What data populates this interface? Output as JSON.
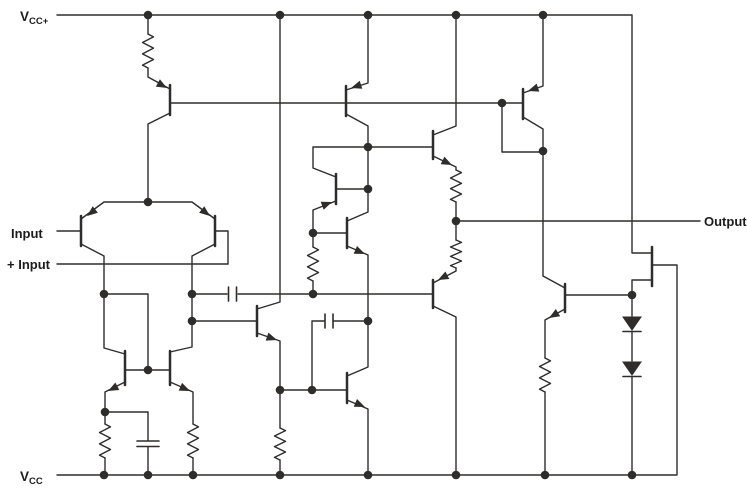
{
  "figure": {
    "width": 747,
    "height": 497,
    "background": "#ffffff",
    "line_color": "#2e2d2c",
    "label_color": "#1c1c1c"
  },
  "labels": [
    {
      "id": "vcc-plus-label",
      "main": "V",
      "sub": "CC+",
      "x": 20,
      "y": 21,
      "size": 13.5,
      "subsize": 9.5
    },
    {
      "id": "input-label",
      "main": "Input",
      "sub": "",
      "x": 11,
      "y": 238,
      "size": 13,
      "subsize": 9
    },
    {
      "id": "plus-input-label",
      "main": "+ Input",
      "sub": "",
      "x": 7,
      "y": 269,
      "size": 13,
      "subsize": 9
    },
    {
      "id": "output-label",
      "main": "Output",
      "sub": "",
      "x": 704,
      "y": 226,
      "size": 13,
      "subsize": 9
    },
    {
      "id": "vcc-minus-label",
      "main": "V",
      "sub": "CC",
      "x": 20,
      "y": 481,
      "size": 13.5,
      "subsize": 9.5
    }
  ],
  "schematic": {
    "wires": [
      [
        57,
        15,
        632,
        15,
        632,
        253,
        652,
        253
      ],
      [
        57,
        475,
        677,
        475,
        677,
        265,
        653,
        265
      ],
      [
        652,
        280,
        632,
        280,
        632,
        295
      ],
      [
        148,
        15,
        148,
        34
      ],
      [
        148,
        68,
        148,
        77,
        170,
        89
      ],
      [
        170,
        103,
        523,
        103
      ],
      [
        170,
        113,
        148,
        124,
        148,
        202
      ],
      [
        368,
        15,
        368,
        83,
        346,
        90
      ],
      [
        346,
        114,
        368,
        126,
        368,
        212,
        347,
        221
      ],
      [
        543,
        15,
        543,
        86,
        523,
        93
      ],
      [
        523,
        117,
        543,
        129,
        543,
        151
      ],
      [
        502,
        103,
        502,
        152,
        543,
        152
      ],
      [
        543,
        151,
        543,
        276,
        565,
        288
      ],
      [
        368,
        147,
        433,
        147
      ],
      [
        433,
        135,
        456,
        126,
        456,
        15
      ],
      [
        433,
        156,
        456,
        167,
        456,
        170
      ],
      [
        456,
        202,
        456,
        240
      ],
      [
        456,
        268,
        456,
        271,
        433,
        283
      ],
      [
        456,
        221,
        700,
        221
      ],
      [
        433,
        306,
        456,
        317,
        456,
        475
      ],
      [
        336,
        177,
        313,
        168,
        313,
        147,
        368,
        147
      ],
      [
        336,
        189,
        368,
        189
      ],
      [
        336,
        201,
        313,
        210,
        313,
        233
      ],
      [
        313,
        233,
        347,
        233
      ],
      [
        313,
        233,
        313,
        247
      ],
      [
        313,
        281,
        313,
        294
      ],
      [
        192,
        294,
        227,
        294
      ],
      [
        238,
        294,
        433,
        294
      ],
      [
        347,
        246,
        368,
        255,
        368,
        367,
        347,
        376
      ],
      [
        324,
        321,
        312,
        321,
        312,
        390
      ],
      [
        334,
        321,
        368,
        321
      ],
      [
        280,
        390,
        347,
        390
      ],
      [
        347,
        400,
        368,
        409,
        368,
        475
      ],
      [
        257,
        309,
        280,
        302,
        280,
        15
      ],
      [
        192,
        321,
        257,
        321
      ],
      [
        257,
        333,
        280,
        341,
        280,
        390
      ],
      [
        280,
        390,
        280,
        428
      ],
      [
        280,
        460,
        280,
        475
      ],
      [
        81,
        219,
        104,
        202,
        192,
        202,
        215,
        219
      ],
      [
        57,
        231,
        81,
        231
      ],
      [
        215,
        231,
        228,
        231,
        228,
        264
      ],
      [
        57,
        264,
        228,
        264
      ],
      [
        81,
        244,
        104,
        256,
        104,
        294
      ],
      [
        215,
        244,
        192,
        256,
        192,
        347,
        170,
        352
      ],
      [
        104,
        294,
        148,
        294,
        148,
        370
      ],
      [
        125,
        370,
        170,
        370
      ],
      [
        125,
        354,
        104,
        348,
        104,
        294
      ],
      [
        125,
        382,
        105,
        392,
        105,
        412
      ],
      [
        105,
        412,
        105,
        424
      ],
      [
        105,
        458,
        105,
        475
      ],
      [
        105,
        412,
        148,
        412,
        148,
        441
      ],
      [
        148,
        447,
        148,
        475
      ],
      [
        170,
        382,
        193,
        392,
        193,
        424
      ],
      [
        193,
        458,
        193,
        475
      ],
      [
        565,
        295,
        632,
        295
      ],
      [
        565,
        309,
        545,
        320,
        545,
        358
      ],
      [
        545,
        392,
        545,
        475
      ],
      [
        632,
        295,
        632,
        316
      ],
      [
        632,
        332,
        632,
        361
      ],
      [
        632,
        377,
        632,
        475
      ]
    ],
    "transistor_bars": [
      [
        170,
        85,
        115
      ],
      [
        346,
        86,
        116
      ],
      [
        523,
        89,
        119
      ],
      [
        81,
        216,
        246
      ],
      [
        215,
        216,
        246
      ],
      [
        125,
        351,
        385
      ],
      [
        170,
        351,
        385
      ],
      [
        257,
        306,
        336
      ],
      [
        336,
        174,
        204
      ],
      [
        347,
        218,
        248
      ],
      [
        433,
        131,
        159
      ],
      [
        433,
        280,
        308
      ],
      [
        565,
        284,
        312
      ],
      [
        347,
        373,
        403
      ],
      [
        652,
        247,
        286
      ]
    ],
    "emitter_arrows": [
      [
        167,
        88,
        29
      ],
      [
        351,
        88,
        162
      ],
      [
        528,
        91,
        161
      ],
      [
        87,
        216,
        142
      ],
      [
        210,
        216,
        38
      ],
      [
        108,
        391,
        153
      ],
      [
        190,
        391,
        24
      ],
      [
        277,
        340,
        19
      ],
      [
        332,
        202,
        -21
      ],
      [
        365,
        254,
        23
      ],
      [
        452,
        165,
        26
      ],
      [
        438,
        280,
        153
      ],
      [
        549,
        318,
        149
      ],
      [
        365,
        407,
        23
      ]
    ],
    "junction_dots": [
      [
        148,
        15
      ],
      [
        280,
        15
      ],
      [
        368,
        15
      ],
      [
        456,
        15
      ],
      [
        543,
        15
      ],
      [
        502,
        103
      ],
      [
        368,
        147
      ],
      [
        543,
        151
      ],
      [
        368,
        189
      ],
      [
        148,
        202
      ],
      [
        456,
        221
      ],
      [
        313,
        233
      ],
      [
        104,
        294
      ],
      [
        192,
        294
      ],
      [
        313,
        294
      ],
      [
        632,
        295
      ],
      [
        192,
        321
      ],
      [
        368,
        321
      ],
      [
        148,
        370
      ],
      [
        280,
        390
      ],
      [
        312,
        390
      ],
      [
        105,
        412
      ],
      [
        104,
        475
      ],
      [
        148,
        475
      ],
      [
        193,
        475
      ],
      [
        280,
        475
      ],
      [
        368,
        475
      ],
      [
        456,
        475
      ],
      [
        545,
        475
      ],
      [
        632,
        475
      ]
    ],
    "resistors": [
      [
        148,
        34,
        68
      ],
      [
        456,
        170,
        202
      ],
      [
        456,
        240,
        268
      ],
      [
        313,
        247,
        281
      ],
      [
        105,
        424,
        458
      ],
      [
        193,
        424,
        458
      ],
      [
        280,
        428,
        460
      ],
      [
        545,
        358,
        392
      ]
    ],
    "capacitors": [
      {
        "orient": "v",
        "x1": 228.5,
        "x2": 236.5,
        "y": 294,
        "half": 7
      },
      {
        "orient": "v",
        "x1": 325,
        "x2": 333,
        "y": 321,
        "half": 7
      },
      {
        "orient": "h",
        "y1": 441,
        "y2": 446.5,
        "x": 148,
        "half": 11
      }
    ],
    "diodes": [
      [
        632,
        317
      ],
      [
        632,
        362
      ]
    ]
  }
}
